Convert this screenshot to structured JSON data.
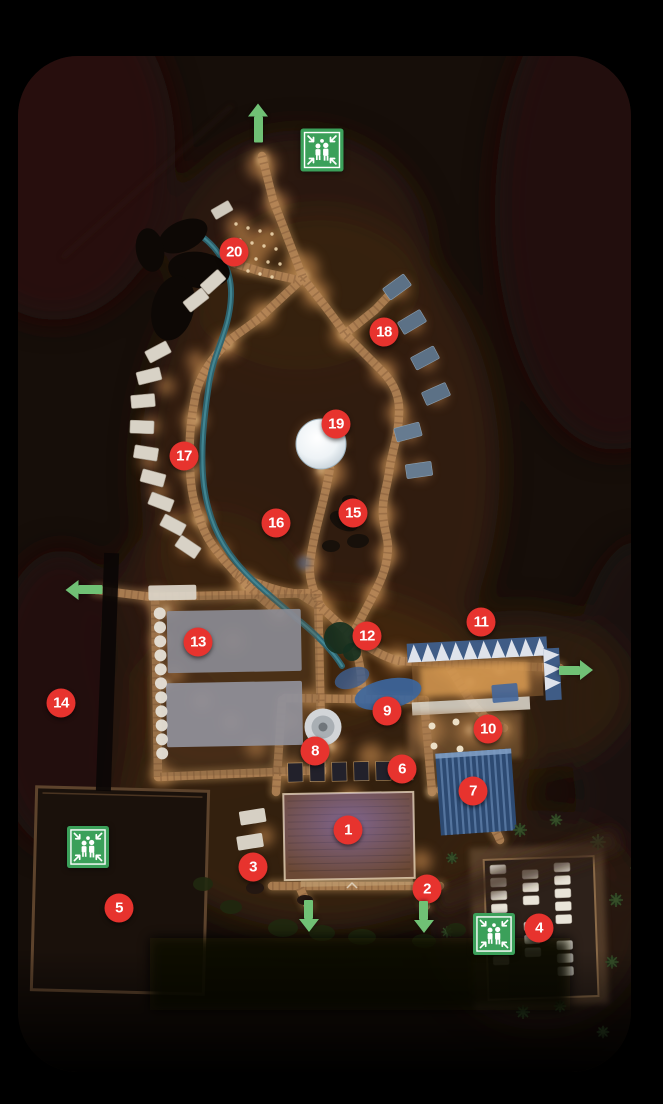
{
  "map": {
    "description": "night aerial site map with numbered points, assembly point signs and evacuation arrows",
    "colors": {
      "marker_red": "#e7332e",
      "marker_text": "#ffffff",
      "safety_green": "#3ba05a",
      "arrow_green": "#70c175",
      "page_background": "#000000"
    },
    "markers": [
      {
        "number": "1",
        "x": 348,
        "y": 830
      },
      {
        "number": "2",
        "x": 427,
        "y": 889
      },
      {
        "number": "3",
        "x": 253,
        "y": 867
      },
      {
        "number": "4",
        "x": 539,
        "y": 928
      },
      {
        "number": "5",
        "x": 119,
        "y": 908
      },
      {
        "number": "6",
        "x": 402,
        "y": 769
      },
      {
        "number": "7",
        "x": 473,
        "y": 791
      },
      {
        "number": "8",
        "x": 315,
        "y": 751
      },
      {
        "number": "9",
        "x": 387,
        "y": 711
      },
      {
        "number": "10",
        "x": 488,
        "y": 729
      },
      {
        "number": "11",
        "x": 481,
        "y": 622
      },
      {
        "number": "12",
        "x": 367,
        "y": 636
      },
      {
        "number": "13",
        "x": 198,
        "y": 642
      },
      {
        "number": "14",
        "x": 61,
        "y": 703
      },
      {
        "number": "15",
        "x": 353,
        "y": 513
      },
      {
        "number": "16",
        "x": 276,
        "y": 523
      },
      {
        "number": "17",
        "x": 184,
        "y": 456
      },
      {
        "number": "18",
        "x": 384,
        "y": 332
      },
      {
        "number": "19",
        "x": 336,
        "y": 424
      },
      {
        "number": "20",
        "x": 234,
        "y": 252
      }
    ],
    "assembly_points": [
      {
        "icon": "assembly-point-icon",
        "x": 322,
        "y": 150,
        "size": 43
      },
      {
        "icon": "assembly-point-icon",
        "x": 88,
        "y": 847,
        "size": 42
      },
      {
        "icon": "assembly-point-icon",
        "x": 494,
        "y": 934,
        "size": 42
      }
    ],
    "exit_arrows": [
      {
        "icon": "arrow-up-icon",
        "direction": "up",
        "x": 258,
        "y": 123,
        "length": 39
      },
      {
        "icon": "arrow-left-icon",
        "direction": "left",
        "x": 84,
        "y": 590,
        "length": 37
      },
      {
        "icon": "arrow-right-icon",
        "direction": "right",
        "x": 576,
        "y": 670,
        "length": 34
      },
      {
        "icon": "arrow-down-icon",
        "direction": "down",
        "x": 309,
        "y": 916,
        "length": 32
      },
      {
        "icon": "arrow-down-icon",
        "direction": "down",
        "x": 424,
        "y": 917,
        "length": 32
      }
    ]
  }
}
